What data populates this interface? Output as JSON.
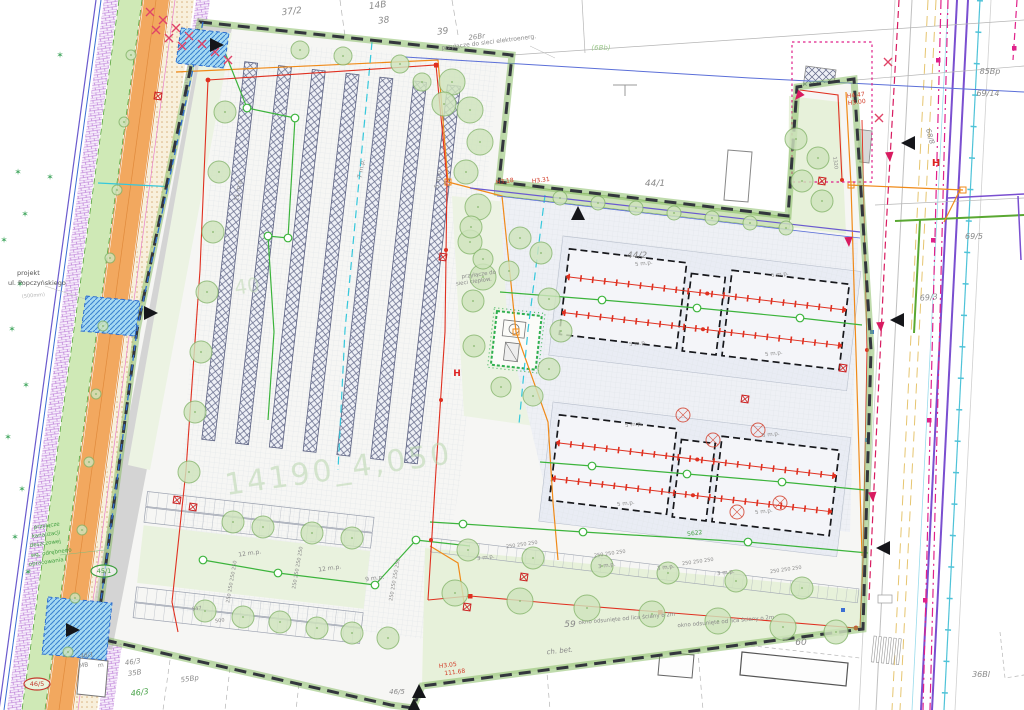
{
  "colors": {
    "boundary": "#33363d",
    "hedge": "#7fb75a",
    "red_power": "#e03020",
    "magenta_cable": "#e0218a",
    "crimson": "#d81b60",
    "orange_line": "#f08a18",
    "green_line": "#3cb43c",
    "cyan_line": "#35c8dc",
    "purple_line": "#7a4fd0",
    "blue_line": "#3b6fd4",
    "tree_fill": "#cfe4bd",
    "tree_edge": "#85b56b",
    "road_fill": "#f2a85f",
    "gray_label": "#8a8a8a",
    "red_label": "#d23c28",
    "green_label": "#3f9e3f",
    "watermark": "#b9d6ae",
    "star": "#2f9e4f"
  },
  "watermark": {
    "main": "14190_4,050",
    "fragment": "40"
  },
  "labels": [
    {
      "t": "37/2",
      "x": 292,
      "y": 14,
      "s": 9,
      "i": 1,
      "r": -7
    },
    {
      "t": "14B",
      "x": 378,
      "y": 8,
      "s": 9,
      "i": 1,
      "r": -7
    },
    {
      "t": "38",
      "x": 384,
      "y": 23,
      "s": 9,
      "i": 1,
      "r": -7
    },
    {
      "t": "39",
      "x": 443,
      "y": 34,
      "s": 9,
      "i": 1,
      "r": -7
    },
    {
      "t": "26Br",
      "x": 477,
      "y": 39,
      "s": 7,
      "i": 1,
      "r": -7
    },
    {
      "t": "przyłącze do sieci elektroenerg.",
      "x": 489,
      "y": 44,
      "s": 6,
      "r": -7
    },
    {
      "t": "(6Bb)",
      "x": 601,
      "y": 50,
      "s": 7,
      "c": "#9fc98f",
      "i": 1
    },
    {
      "t": "44/1",
      "x": 655,
      "y": 186,
      "s": 9,
      "i": 1
    },
    {
      "t": "44/2",
      "x": 637,
      "y": 258,
      "s": 9,
      "i": 1
    },
    {
      "t": "H3.18",
      "x": 505,
      "y": 183,
      "s": 6,
      "c": "#d23c28",
      "r": -7
    },
    {
      "t": "H3.31",
      "x": 541,
      "y": 182,
      "s": 6,
      "c": "#d23c28",
      "r": -7
    },
    {
      "t": "85Bp",
      "x": 990,
      "y": 74,
      "s": 8,
      "i": 1
    },
    {
      "t": "69/14",
      "x": 988,
      "y": 96,
      "s": 8,
      "i": 1
    },
    {
      "t": "68/8",
      "x": 928,
      "y": 137,
      "s": 7,
      "i": 1,
      "r": 75
    },
    {
      "t": "69/5",
      "x": 974,
      "y": 239,
      "s": 8,
      "i": 1
    },
    {
      "t": "69/3",
      "x": 929,
      "y": 300,
      "s": 8,
      "i": 1,
      "r": -5
    },
    {
      "t": "36Bl",
      "x": 981,
      "y": 677,
      "s": 8,
      "i": 1
    },
    {
      "t": "60",
      "x": 801,
      "y": 645,
      "s": 9,
      "i": 1
    },
    {
      "t": "59",
      "x": 570,
      "y": 627,
      "s": 9,
      "i": 1
    },
    {
      "t": "ch. bet.",
      "x": 560,
      "y": 653,
      "s": 7,
      "i": 1,
      "r": -6
    },
    {
      "t": "okno odsunięte od lica ściany o 2m",
      "x": 627,
      "y": 620,
      "s": 5.5,
      "r": -5
    },
    {
      "t": "okno odsunięte od lica ściany o 2m",
      "x": 726,
      "y": 623,
      "s": 5.5,
      "r": -5
    },
    {
      "t": "H3.05",
      "x": 448,
      "y": 667,
      "s": 6,
      "c": "#d23c28",
      "r": -7
    },
    {
      "t": "111.68",
      "x": 455,
      "y": 674,
      "s": 6,
      "c": "#d23c28",
      "r": -7
    },
    {
      "t": "46/5",
      "x": 397,
      "y": 694,
      "s": 7,
      "i": 1
    },
    {
      "t": "46/5",
      "x": 37,
      "y": 686,
      "s": 6.5,
      "c": "#c43a2e",
      "el": "#c43a2e"
    },
    {
      "t": "45/1",
      "x": 104,
      "y": 573,
      "s": 6.5,
      "c": "#3f9e3f",
      "el": "#3f9e3f"
    },
    {
      "t": "46/1",
      "x": 87,
      "y": 657,
      "s": 6,
      "i": 1,
      "r": -8
    },
    {
      "t": "MB",
      "x": 84,
      "y": 667,
      "s": 6,
      "r": -8
    },
    {
      "t": "m",
      "x": 101,
      "y": 667,
      "s": 6,
      "r": -8
    },
    {
      "t": "46/3",
      "x": 133,
      "y": 664,
      "s": 7,
      "i": 1,
      "r": -8
    },
    {
      "t": "35B",
      "x": 135,
      "y": 675,
      "s": 7,
      "i": 1,
      "r": -8
    },
    {
      "t": "55Bp",
      "x": 190,
      "y": 681,
      "s": 7,
      "i": 1,
      "r": -8
    },
    {
      "t": "46/3",
      "x": 140,
      "y": 695,
      "s": 8,
      "c": "#3f9e3f",
      "i": 1,
      "r": -8
    },
    {
      "t": "projekt",
      "x": 17,
      "y": 275,
      "s": 6.5,
      "c": "#555555",
      "a": "start"
    },
    {
      "t": "ul. Popczyńskiego",
      "x": 8,
      "y": 285,
      "s": 6.5,
      "c": "#555555",
      "a": "start"
    },
    {
      "t": "(500mm)",
      "x": 22,
      "y": 298,
      "s": 5,
      "c": "#b5b5b5",
      "a": "start",
      "r": -5
    },
    {
      "t": "przyłącze",
      "x": 34,
      "y": 529,
      "s": 5.5,
      "c": "#3f9e3f",
      "a": "start",
      "r": -8
    },
    {
      "t": "kanalizacji",
      "x": 32,
      "y": 538,
      "s": 5.5,
      "c": "#3f9e3f",
      "a": "start",
      "r": -8
    },
    {
      "t": "deszczowej",
      "x": 30,
      "y": 547,
      "s": 5.5,
      "c": "#3f9e3f",
      "a": "start",
      "r": -8
    },
    {
      "t": "wg. odrębnego",
      "x": 31,
      "y": 557,
      "s": 5.5,
      "c": "#3f9e3f",
      "a": "start",
      "r": -8
    },
    {
      "t": "opracowania",
      "x": 29,
      "y": 566,
      "s": 5.5,
      "c": "#3f9e3f",
      "a": "start",
      "r": -8
    },
    {
      "t": "11 m.p.",
      "x": 240,
      "y": 190,
      "s": 6,
      "r": -80
    },
    {
      "t": "7 m.p.",
      "x": 363,
      "y": 169,
      "s": 6,
      "r": -80
    },
    {
      "t": "5 m.p.",
      "x": 440,
      "y": 179,
      "s": 6,
      "r": -80
    },
    {
      "t": "5 m.p.",
      "x": 644,
      "y": 265,
      "s": 5.5,
      "r": -7
    },
    {
      "t": "5 m.p.",
      "x": 780,
      "y": 276,
      "s": 5.5,
      "r": -7
    },
    {
      "t": "5 m.p.",
      "x": 638,
      "y": 345,
      "s": 5.5,
      "r": -7
    },
    {
      "t": "5 m.p.",
      "x": 774,
      "y": 355,
      "s": 5.5,
      "r": -7
    },
    {
      "t": "5 m.p.",
      "x": 634,
      "y": 426,
      "s": 5.5,
      "r": -7
    },
    {
      "t": "5 m.p.",
      "x": 771,
      "y": 436,
      "s": 5.5,
      "r": -7
    },
    {
      "t": "5 m.p.",
      "x": 626,
      "y": 505,
      "s": 5.5,
      "r": -7
    },
    {
      "t": "5 m.p.",
      "x": 764,
      "y": 513,
      "s": 5.5,
      "r": -7
    },
    {
      "t": "12 m.p.",
      "x": 250,
      "y": 555,
      "s": 6,
      "r": -8
    },
    {
      "t": "12 m.p.",
      "x": 330,
      "y": 570,
      "s": 6,
      "r": -8
    },
    {
      "t": "9 m.p.",
      "x": 375,
      "y": 580,
      "s": 6,
      "r": -8
    },
    {
      "t": "3 m.p.",
      "x": 486,
      "y": 559,
      "s": 5.5,
      "r": -8
    },
    {
      "t": "3 m.p.",
      "x": 607,
      "y": 567,
      "s": 5.5,
      "r": -8
    },
    {
      "t": "3 m.p.",
      "x": 666,
      "y": 569,
      "s": 5.5,
      "r": -8
    },
    {
      "t": "3 m.p.",
      "x": 726,
      "y": 574,
      "s": 5.5,
      "r": -8
    },
    {
      "t": "250  250  250",
      "x": 522,
      "y": 546,
      "s": 5,
      "r": -8
    },
    {
      "t": "250  250  250",
      "x": 610,
      "y": 555,
      "s": 5,
      "r": -8
    },
    {
      "t": "250  250  250",
      "x": 698,
      "y": 563,
      "s": 5,
      "r": -8
    },
    {
      "t": "250  250  250",
      "x": 786,
      "y": 571,
      "s": 5,
      "r": -8
    },
    {
      "t": "250 250 250 250",
      "x": 233,
      "y": 582,
      "s": 5,
      "r": -80
    },
    {
      "t": "250 250 250 250",
      "x": 299,
      "y": 568,
      "s": 5,
      "r": -80
    },
    {
      "t": "250 250 250 250",
      "x": 396,
      "y": 580,
      "s": 5,
      "r": -80
    },
    {
      "t": "5622",
      "x": 695,
      "y": 535,
      "s": 6,
      "c": "#3f9e3f",
      "r": -8
    },
    {
      "t": "547",
      "x": 197,
      "y": 610,
      "s": 5,
      "r": -8
    },
    {
      "t": "500",
      "x": 220,
      "y": 622,
      "s": 5,
      "r": -8
    },
    {
      "t": "1320",
      "x": 834,
      "y": 163,
      "s": 5,
      "r": 83
    },
    {
      "t": "H4.47",
      "x": 856,
      "y": 97,
      "s": 6,
      "c": "#d23c28",
      "r": -7
    },
    {
      "t": "H3.00",
      "x": 857,
      "y": 104,
      "s": 6,
      "c": "#d23c28",
      "r": -7
    },
    {
      "t": "przyłącze do",
      "x": 479,
      "y": 276,
      "s": 5.5,
      "r": -8
    },
    {
      "t": "sieci ciepłow.",
      "x": 474,
      "y": 283,
      "s": 5.5,
      "r": -8
    },
    {
      "t": "14190_4,050",
      "x": 340,
      "y": 479,
      "s": 30,
      "c": "#b9d6ae",
      "r": -8,
      "o": 0.55,
      "ls": 3
    },
    {
      "t": "40",
      "x": 248,
      "y": 293,
      "s": 20,
      "c": "#b9d6ae",
      "r": -8,
      "o": 0.5
    },
    {
      "t": "H",
      "x": 936,
      "y": 166,
      "s": 10,
      "c": "#dd2222",
      "b": 1
    },
    {
      "t": "H",
      "x": 457,
      "y": 376,
      "s": 9,
      "c": "#dd2222",
      "b": 1
    }
  ],
  "plan": {
    "trees": [
      [
        131,
        55,
        5
      ],
      [
        124,
        122,
        5
      ],
      [
        117,
        190,
        5
      ],
      [
        110,
        258,
        5
      ],
      [
        103,
        326,
        5
      ],
      [
        96,
        394,
        5
      ],
      [
        89,
        462,
        5
      ],
      [
        82,
        530,
        5
      ],
      [
        75,
        598,
        5
      ],
      [
        68,
        652,
        5
      ],
      [
        225,
        112,
        11
      ],
      [
        219,
        172,
        11
      ],
      [
        213,
        232,
        11
      ],
      [
        207,
        292,
        11
      ],
      [
        201,
        352,
        11
      ],
      [
        195,
        412,
        11
      ],
      [
        189,
        472,
        11
      ],
      [
        300,
        50,
        9
      ],
      [
        343,
        56,
        9
      ],
      [
        400,
        64,
        9
      ],
      [
        422,
        82,
        9
      ],
      [
        452,
        82,
        13
      ],
      [
        444,
        104,
        12
      ],
      [
        470,
        110,
        13
      ],
      [
        480,
        142,
        13
      ],
      [
        466,
        172,
        12
      ],
      [
        478,
        207,
        13
      ],
      [
        470,
        242,
        12
      ],
      [
        483,
        277,
        13
      ],
      [
        471,
        227,
        11
      ],
      [
        520,
        238,
        11
      ],
      [
        483,
        259,
        10
      ],
      [
        509,
        271,
        10
      ],
      [
        541,
        253,
        11
      ],
      [
        473,
        301,
        11
      ],
      [
        549,
        299,
        11
      ],
      [
        561,
        331,
        11
      ],
      [
        474,
        346,
        11
      ],
      [
        549,
        369,
        11
      ],
      [
        501,
        387,
        10
      ],
      [
        533,
        396,
        10
      ],
      [
        560,
        198,
        7
      ],
      [
        598,
        203,
        7
      ],
      [
        636,
        208,
        7
      ],
      [
        674,
        213,
        7
      ],
      [
        712,
        218,
        7
      ],
      [
        750,
        223,
        7
      ],
      [
        786,
        228,
        7
      ],
      [
        796,
        139,
        11
      ],
      [
        818,
        158,
        11
      ],
      [
        802,
        181,
        11
      ],
      [
        822,
        201,
        11
      ],
      [
        455,
        593,
        13
      ],
      [
        520,
        601,
        13
      ],
      [
        587,
        608,
        13
      ],
      [
        652,
        614,
        13
      ],
      [
        718,
        621,
        13
      ],
      [
        783,
        627,
        13
      ],
      [
        836,
        632,
        12
      ],
      [
        468,
        550,
        11
      ],
      [
        533,
        558,
        11
      ],
      [
        602,
        566,
        11
      ],
      [
        668,
        573,
        11
      ],
      [
        736,
        581,
        11
      ],
      [
        802,
        588,
        11
      ],
      [
        233,
        522,
        11
      ],
      [
        263,
        527,
        11
      ],
      [
        312,
        533,
        11
      ],
      [
        352,
        538,
        11
      ],
      [
        205,
        611,
        11
      ],
      [
        243,
        617,
        11
      ],
      [
        280,
        622,
        11
      ],
      [
        317,
        628,
        11
      ],
      [
        352,
        633,
        11
      ],
      [
        388,
        638,
        11
      ]
    ],
    "stars": [
      [
        60,
        58
      ],
      [
        50,
        180
      ],
      [
        18,
        175
      ],
      [
        25,
        217
      ],
      [
        4,
        243
      ],
      [
        20,
        287
      ],
      [
        12,
        332
      ],
      [
        26,
        388
      ],
      [
        8,
        440
      ],
      [
        22,
        492
      ],
      [
        15,
        540
      ],
      [
        28,
        575
      ]
    ],
    "crosses": [
      [
        150,
        12
      ],
      [
        163,
        20
      ],
      [
        176,
        28
      ],
      [
        189,
        36
      ],
      [
        202,
        44
      ],
      [
        215,
        52
      ],
      [
        228,
        60
      ],
      [
        156,
        30
      ],
      [
        169,
        38
      ],
      [
        182,
        46
      ],
      [
        888,
        62
      ],
      [
        879,
        118
      ]
    ],
    "triangles": [
      [
        216,
        45,
        "right"
      ],
      [
        578,
        214,
        "up"
      ],
      [
        909,
        143,
        "left"
      ],
      [
        898,
        320,
        "left"
      ],
      [
        884,
        548,
        "left"
      ],
      [
        150,
        313,
        "right"
      ],
      [
        72,
        630,
        "right"
      ],
      [
        419,
        692,
        "up"
      ],
      [
        414,
        706,
        "up"
      ]
    ],
    "arrows": [
      [
        890,
        162,
        -4
      ],
      [
        881,
        332,
        -4
      ],
      [
        873,
        502,
        -4
      ],
      [
        849,
        247,
        -3
      ],
      [
        795,
        100,
        40
      ]
    ],
    "redboxes": [
      [
        443,
        257
      ],
      [
        177,
        500
      ],
      [
        193,
        507
      ],
      [
        467,
        607
      ],
      [
        843,
        368
      ],
      [
        822,
        181
      ],
      [
        524,
        577
      ],
      [
        158,
        96
      ],
      [
        745,
        399
      ]
    ],
    "redcircles": [
      [
        683,
        415
      ],
      [
        758,
        430
      ],
      [
        780,
        503
      ],
      [
        713,
        440
      ],
      [
        737,
        512
      ]
    ]
  }
}
